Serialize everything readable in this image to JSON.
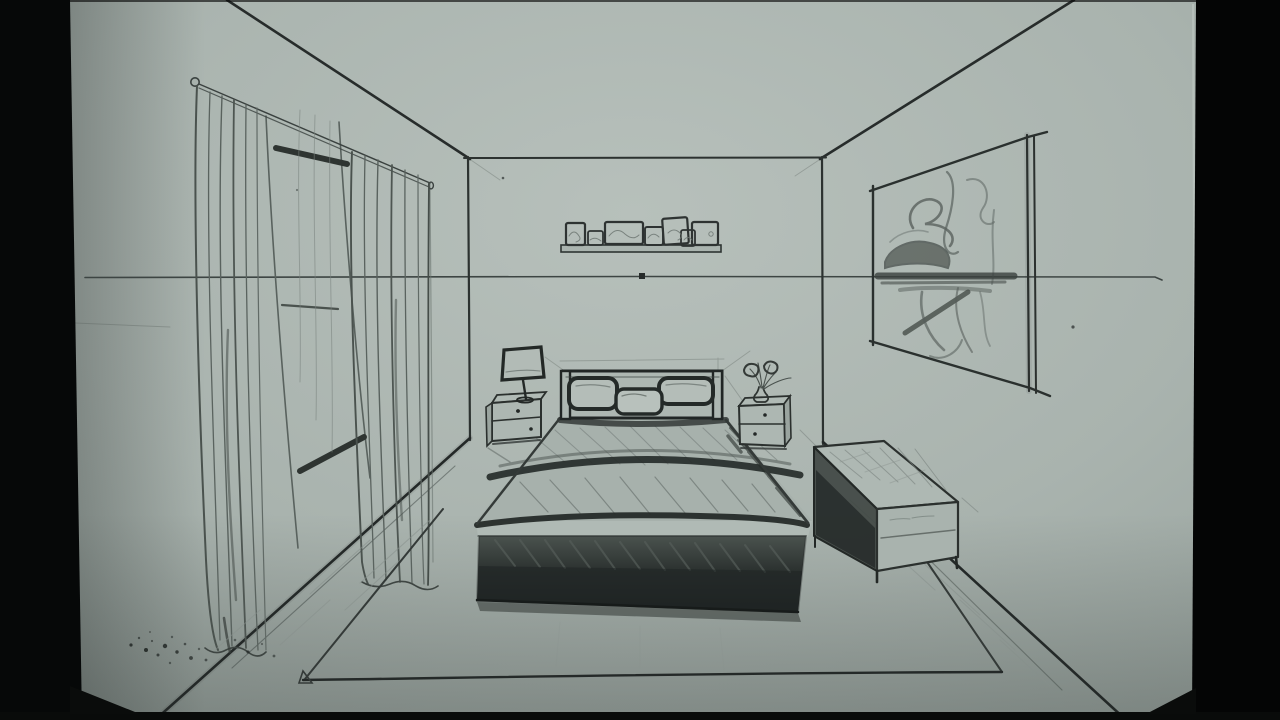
{
  "image": {
    "kind": "photograph of a hand-drawn pencil sketch",
    "subject": "bedroom interior drawn in one-point perspective on paper, letterboxed by dark edges",
    "width_px": 1280,
    "height_px": 720
  },
  "palette": {
    "frame_black": "#050606",
    "paper_light": "#b6bfba",
    "paper_mid": "#a6b0ab",
    "paper_dark": "#96a09b",
    "pencil_faint": "#7d8682",
    "pencil_medium": "#4a524e",
    "pencil_dark": "#2a302e",
    "pencil_heavy": "#1b201f"
  },
  "perspective": {
    "vanishing_point": {
      "x": 641,
      "y": 276
    },
    "horizon_y": 277,
    "ceiling_left_start": {
      "x": 227,
      "y": 0
    },
    "ceiling_right_start": {
      "x": 1074,
      "y": 0
    },
    "floor_left_end": {
      "x": 155,
      "y": 720
    },
    "floor_right_end": {
      "x": 1126,
      "y": 720
    }
  },
  "scene": {
    "back_wall": {
      "x1": 468,
      "y1": 158,
      "x2": 822,
      "y2": 442
    },
    "elements": [
      {
        "name": "horizon-line",
        "desc": "thin horizontal guide line with vanishing point dot"
      },
      {
        "name": "curtain-rod",
        "desc": "rod with round finial, upper left wall"
      },
      {
        "name": "curtains",
        "desc": "two sheer wavy curtain panels on left wall"
      },
      {
        "name": "ladder-window",
        "desc": "leaning rails with three dark cross bars between curtains"
      },
      {
        "name": "wall-shelf",
        "desc": "floating shelf with seven small picture frames on back wall"
      },
      {
        "name": "wall-painting",
        "desc": "large abstract scribble artwork on right wall"
      },
      {
        "name": "bed",
        "desc": "double bed with headboard, three pillows, duvet folds and dark base"
      },
      {
        "name": "nightstand-left",
        "desc": "two-drawer nightstand with table lamp"
      },
      {
        "name": "nightstand-right",
        "desc": "two-drawer nightstand with flower vase"
      },
      {
        "name": "bench",
        "desc": "long upholstered bench at right, dark shaded side"
      },
      {
        "name": "rug",
        "desc": "large area rug under the bed, corner fold at front left"
      },
      {
        "name": "floor-smudges",
        "desc": "graphite speckles near bottom left of paper"
      }
    ]
  }
}
